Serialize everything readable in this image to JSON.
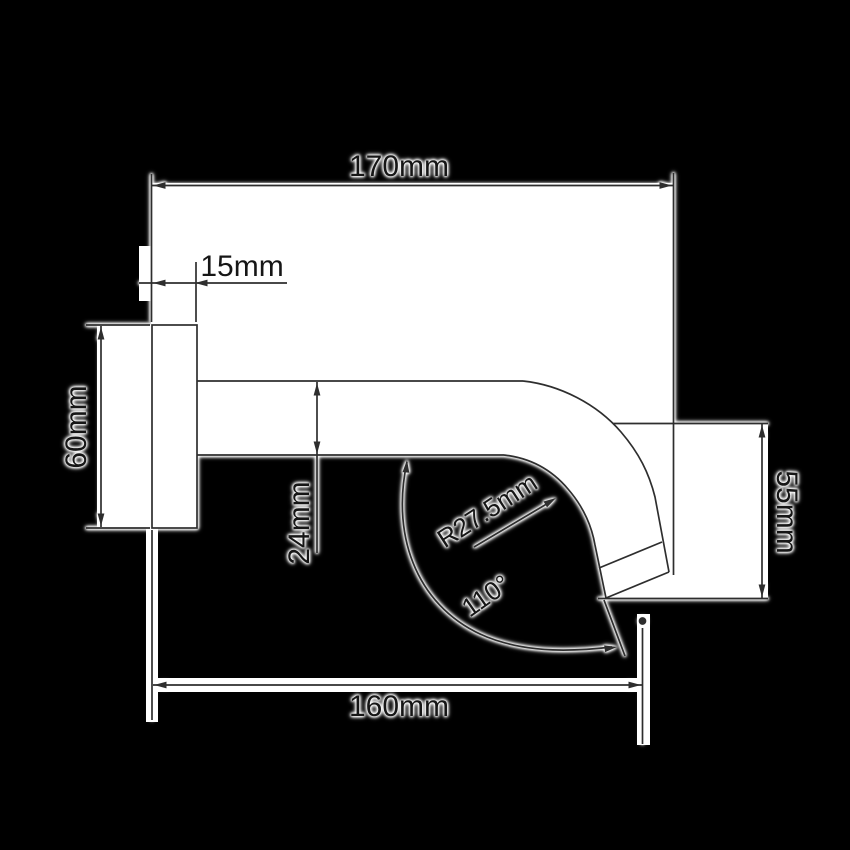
{
  "diagram": {
    "labels": {
      "top_width": "170mm",
      "wall_offset": "15mm",
      "flange_height": "60mm",
      "tube_diameter": "24mm",
      "bend_radius": "R27.5mm",
      "outlet_angle": "110°",
      "drop_height": "55mm",
      "bottom_reach": "160mm"
    },
    "colors": {
      "background": "#000000",
      "paper": "#ffffff",
      "line": "#2e2e2e",
      "text": "#161616"
    }
  }
}
